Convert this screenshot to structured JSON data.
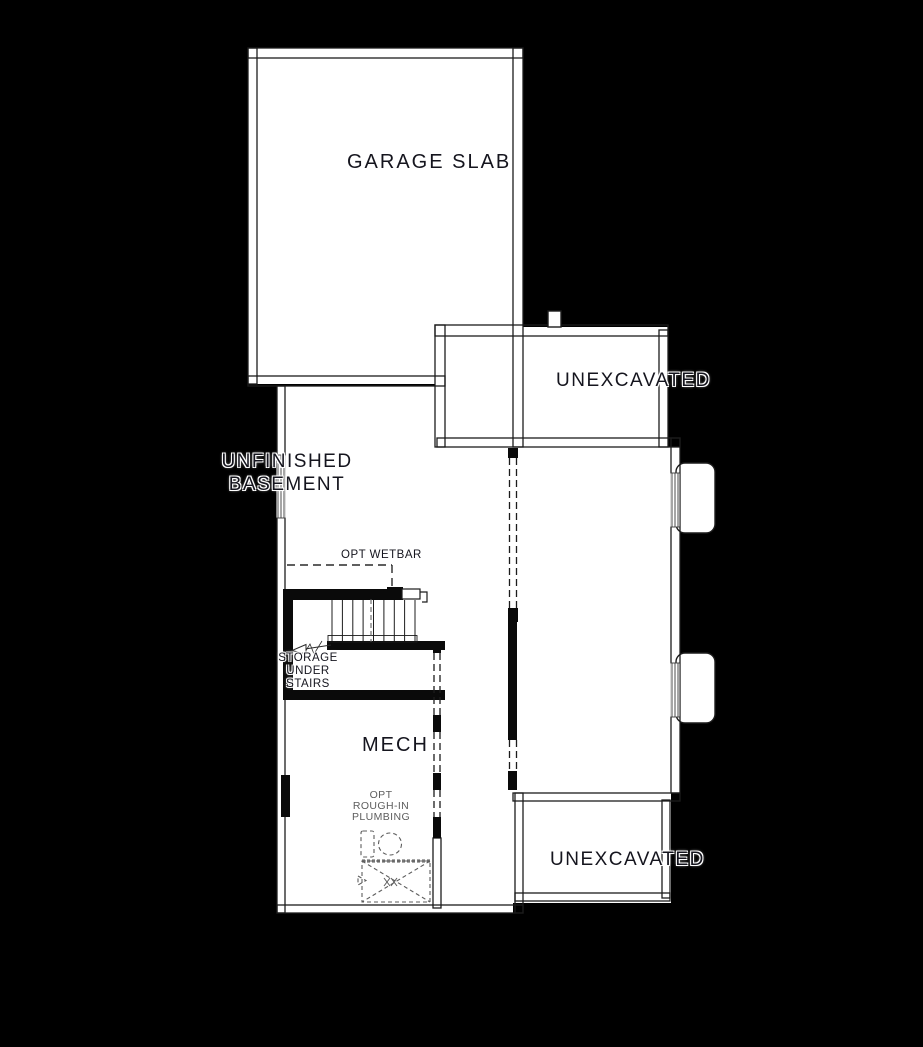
{
  "title": "Basement Floor Plan",
  "colors": {
    "background": "#000000",
    "paper": "#ffffff",
    "line": "#1c1c1c",
    "label": "#15151e",
    "muted": "#5d5d5d"
  },
  "labels": {
    "garage_slab": "GARAGE SLAB",
    "unexcavated_upper": "UNEXCAVATED",
    "unexcavated_lower": "UNEXCAVATED",
    "unfinished_basement": {
      "line1": "UNFINISHED",
      "line2": "BASEMENT"
    },
    "opt_wetbar": "OPT WETBAR",
    "storage_under_stairs": {
      "line1": "STORAGE",
      "line2": "UNDER",
      "line3": "STAIRS"
    },
    "mech": "MECH",
    "opt_rough_in_plumbing": {
      "line1": "OPT",
      "line2": "ROUGH-IN",
      "line3": "PLUMBING"
    }
  }
}
